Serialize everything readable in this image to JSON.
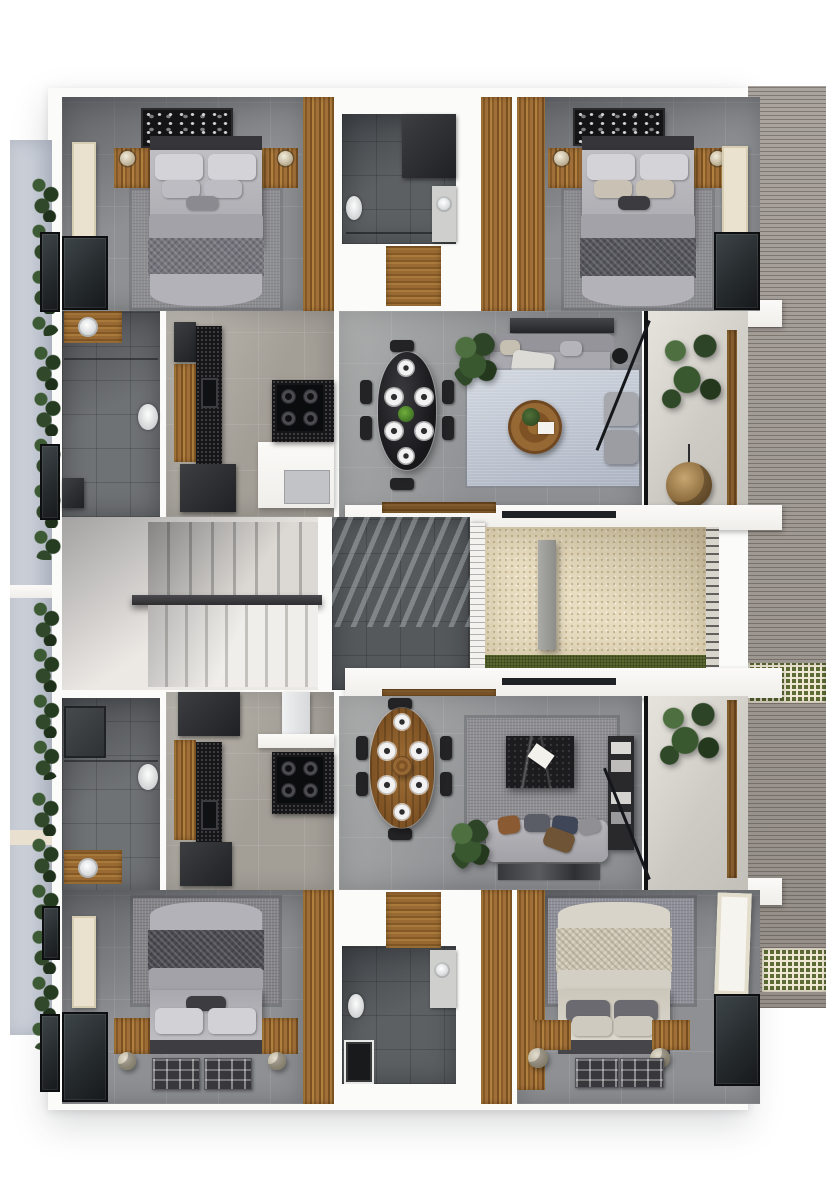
{
  "meta": {
    "type": "3d-floor-plan-render",
    "description": "Top-down 3D architectural rendering of one residential floor with two mirrored apartment units (each: two bedrooms, two bathrooms, kitchen, dining, living room, balcony) separated by a central staircase, dark-tiled corridor and a gravel courtyard. Slatted roof deck with planted lattice bands on the right, planted side walkway on the left. No text labels are rendered in the image."
  },
  "palette": {
    "wall": "#fbfaf8",
    "floor": "#8e9093",
    "floor-dark": "#5c6063",
    "floor-warm": "#a39e96",
    "wood": "#a1703a",
    "counter": "#161618",
    "glass": "#262b2e",
    "gravel": "#e8ddc1",
    "grass": "#5a672f",
    "deck": "#a49d97",
    "lattice": "#5d6b34",
    "walkway": "#b9bfca",
    "rug-blue": "#c3cad6",
    "rug-gray": "#8f8f94",
    "bed-gray": "#b7b6bc",
    "bed-cream": "#d8d3c8",
    "art-beige": "#eae2cf",
    "marble": "#1c1c1f",
    "plant": "#2d4526"
  },
  "scene": {
    "shared_zones": [
      "staircase",
      "corridor",
      "courtyard",
      "side-walkway",
      "roof-deck"
    ],
    "units": [
      {
        "name": "upper-unit",
        "rooms": [
          "bedroom-left",
          "bathroom-center",
          "bedroom-right",
          "bathroom",
          "kitchen",
          "dining",
          "living",
          "balcony"
        ]
      },
      {
        "name": "lower-unit",
        "rooms": [
          "bathroom",
          "kitchen",
          "dining",
          "living",
          "balcony",
          "bedroom-left",
          "bathroom-center",
          "bedroom-right"
        ]
      }
    ],
    "furniture": [
      "double-bed",
      "nightstand",
      "table-lamp",
      "area-rug",
      "wall-art",
      "wardrobe",
      "toilet",
      "vanity-basin",
      "shower",
      "kitchen-island",
      "gas-hob",
      "sink",
      "refrigerator",
      "dining-table",
      "dining-chair",
      "plate-setting",
      "sofa",
      "coffee-table",
      "tv-console",
      "armchair",
      "hanging-chair",
      "potted-plant",
      "shelving-unit",
      "stair-handrail"
    ]
  }
}
